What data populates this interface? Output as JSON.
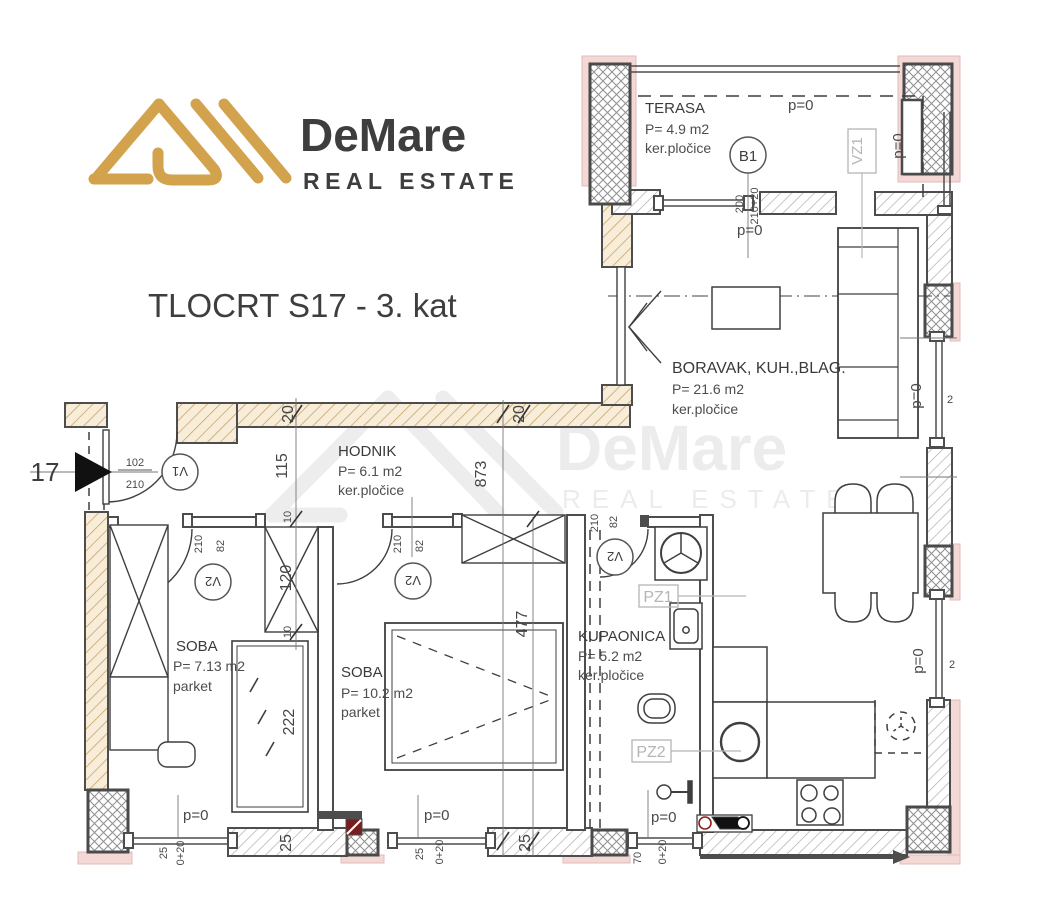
{
  "header": {
    "brand": "DeMare",
    "tagline": "REAL ESTATE",
    "title": "TLOCRT S17 - 3. kat"
  },
  "watermark": {
    "brand": "DeMare",
    "tagline": "REAL ESTATE"
  },
  "rooms": {
    "terasa": {
      "name": "TERASA",
      "area": "P= 4.9 m2",
      "floor": "ker.pločice"
    },
    "boravak": {
      "name": "BORAVAK, KUH.,BLAG.",
      "area": "P= 21.6 m2",
      "floor": "ker.pločice"
    },
    "hodnik": {
      "name": "HODNIK",
      "area": "P= 6.1 m2",
      "floor": "ker.pločice"
    },
    "soba1": {
      "name": "SOBA",
      "area": "P= 7.13 m2",
      "floor": "parket"
    },
    "soba2": {
      "name": "SOBA",
      "area": "P= 10.2 m2",
      "floor": "parket"
    },
    "kupaonica": {
      "name": "KUPAONICA",
      "area": "P= 5.2 m2",
      "floor": "ker.pločice"
    }
  },
  "markers": {
    "b1": "B1",
    "v1": "V1",
    "v2": "V2",
    "vz1": "VZ1",
    "pz1": "PZ1",
    "pz2": "PZ2",
    "entrance_no": "17"
  },
  "levels": {
    "p0": "p=0"
  },
  "dims": {
    "d20": "20",
    "d115": "115",
    "d873": "873",
    "d10": "10",
    "d120": "120",
    "d102": "102",
    "d210": "210",
    "d82": "82",
    "d222": "222",
    "d477": "477",
    "d25": "25",
    "d0_20": "0+20",
    "d70": "70",
    "d2": "2",
    "d200": "200",
    "d210_20": "210+20"
  },
  "colors": {
    "gold": "#D2A24C",
    "dark": "#333D48",
    "wall": "#4D4D4D",
    "pink": "#F3D8D5",
    "tan_line": "#C49A60",
    "gray_label": "#B5B5B5"
  }
}
